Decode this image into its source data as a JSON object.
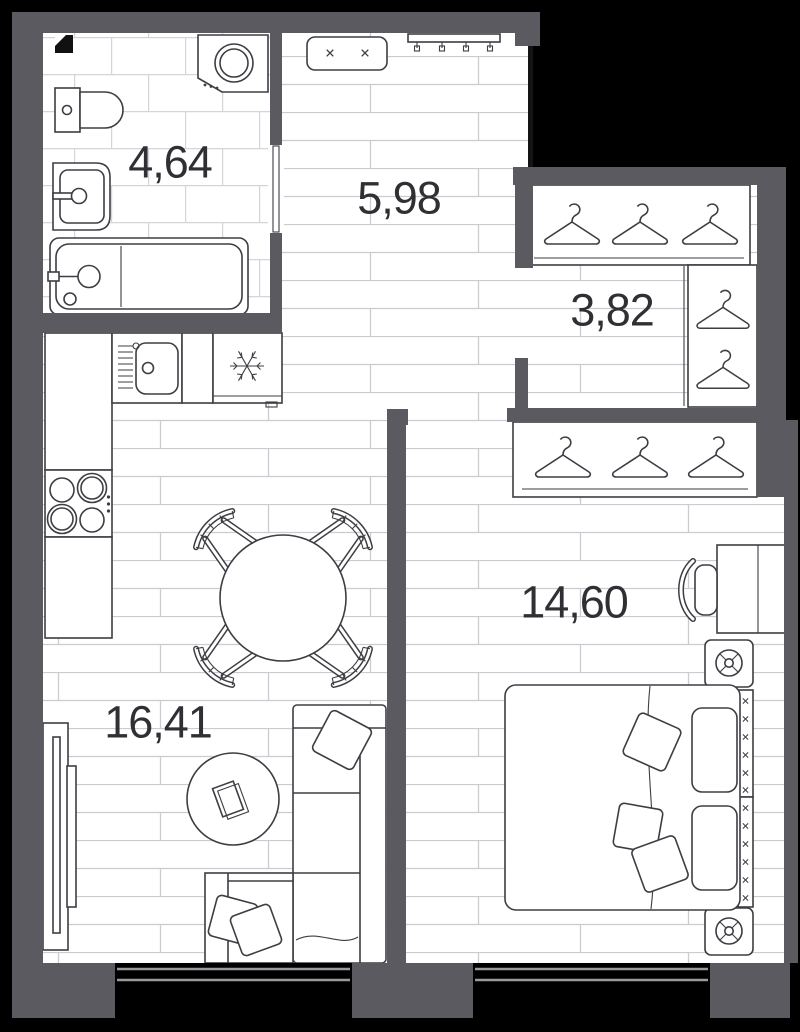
{
  "plan": {
    "title": "apartment-floor-plan",
    "background": "#000000",
    "colors": {
      "wall": "#5a5a60",
      "furniture_outline": "#3d3d43",
      "plank_line": "#c9ccd0",
      "tile_line": "#d3d6d9",
      "label_text": "#2f2f34",
      "window_frame": "#9a9a9e"
    },
    "rooms": [
      {
        "id": "bathroom",
        "area_label": "4,64"
      },
      {
        "id": "hallway",
        "area_label": "5,98"
      },
      {
        "id": "dressing-room",
        "area_label": "3,82"
      },
      {
        "id": "bedroom",
        "area_label": "14,60"
      },
      {
        "id": "living-kitchen",
        "area_label": "16,41"
      }
    ]
  }
}
